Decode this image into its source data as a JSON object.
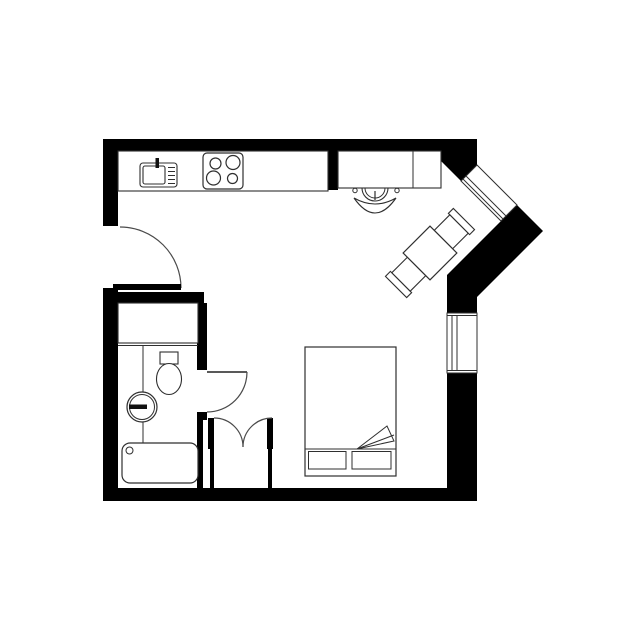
{
  "canvas": {
    "width": 640,
    "height": 640,
    "background": "#ffffff"
  },
  "palette": {
    "wall": "#000000",
    "furniture_line": "#2f2f2f",
    "door_line": "#4a4a4a",
    "fill_white": "#ffffff"
  },
  "plan": {
    "layers": [
      {
        "name": "walls",
        "shapes": [
          {
            "name": "top-and-diagonal-wall",
            "kind": "poly",
            "pts": "103,139 477,139 477,165 461,181 440,160 440,151 103,151",
            "f": "#000000"
          },
          {
            "name": "left-wall-upper",
            "kind": "rect",
            "x": 103,
            "y": 139,
            "w": 15,
            "h": 87,
            "f": "#000000"
          },
          {
            "name": "left-wall-lower",
            "kind": "rect",
            "x": 103,
            "y": 288,
            "w": 15,
            "h": 213,
            "f": "#000000"
          },
          {
            "name": "bottom-wall",
            "kind": "rect",
            "x": 103,
            "y": 488,
            "w": 374,
            "h": 13,
            "f": "#000000"
          },
          {
            "name": "right-wall-lower",
            "kind": "rect",
            "x": 447,
            "y": 373,
            "w": 30,
            "h": 128,
            "f": "#000000"
          },
          {
            "name": "right-wall-mid-chunk",
            "kind": "poly",
            "pts": "516,204 543,231 477,297 477,313 447,313 447,275 501,221",
            "f": "#000000"
          },
          {
            "name": "kitchen-desk-divider-stub",
            "kind": "rect",
            "x": 328,
            "y": 151,
            "w": 10,
            "h": 39,
            "f": "#000000"
          },
          {
            "name": "bathroom-top-wall",
            "kind": "rect",
            "x": 118,
            "y": 292,
            "w": 86,
            "h": 11,
            "f": "#000000"
          },
          {
            "name": "bathroom-side-wall",
            "kind": "rect",
            "x": 197,
            "y": 303,
            "w": 10,
            "h": 67,
            "f": "#000000"
          },
          {
            "name": "bathroom-door-stub",
            "kind": "rect",
            "x": 197,
            "y": 412,
            "w": 10,
            "h": 8,
            "f": "#000000"
          },
          {
            "name": "bathroom-lower-wall",
            "kind": "rect",
            "x": 197,
            "y": 420,
            "w": 6,
            "h": 68,
            "f": "#000000"
          }
        ]
      },
      {
        "name": "windows",
        "shapes": [
          {
            "name": "diagonal-window-frame",
            "kind": "poly",
            "pts": "477,165 517,205 501,221 461,181",
            "f": "#ffffff",
            "s": "#2f2f2f",
            "sw": 1
          },
          {
            "name": "diagonal-window-glass-line-1",
            "kind": "line",
            "x1": 463,
            "y1": 179,
            "x2": 503,
            "y2": 219,
            "s": "#2f2f2f",
            "sw": 1
          },
          {
            "name": "diagonal-window-glass-line-2",
            "kind": "line",
            "x1": 466,
            "y1": 176,
            "x2": 506,
            "y2": 216,
            "s": "#2f2f2f",
            "sw": 1
          },
          {
            "name": "right-window-frame",
            "kind": "rect",
            "x": 447,
            "y": 313,
            "w": 30,
            "h": 60,
            "f": "#ffffff",
            "s": "#2f2f2f",
            "sw": 1
          },
          {
            "name": "right-window-sill-top",
            "kind": "line",
            "x1": 447,
            "y1": 315.5,
            "x2": 477,
            "y2": 315.5,
            "s": "#2f2f2f",
            "sw": 1
          },
          {
            "name": "right-window-sill-bottom",
            "kind": "line",
            "x1": 447,
            "y1": 370.5,
            "x2": 477,
            "y2": 370.5,
            "s": "#2f2f2f",
            "sw": 1
          },
          {
            "name": "right-window-glass-line-1",
            "kind": "line",
            "x1": 452,
            "y1": 315,
            "x2": 452,
            "y2": 371,
            "s": "#2f2f2f",
            "sw": 1
          },
          {
            "name": "right-window-glass-line-2",
            "kind": "line",
            "x1": 457,
            "y1": 315,
            "x2": 457,
            "y2": 371,
            "s": "#2f2f2f",
            "sw": 1
          }
        ]
      },
      {
        "name": "doors",
        "shapes": [
          {
            "name": "entry-door-swing-arc",
            "kind": "path",
            "d": "M120,227 A61,61 0 0 1 181,288",
            "s": "#4a4a4a",
            "sw": 1.2
          },
          {
            "name": "entry-door-leaf",
            "kind": "rect",
            "x": 113,
            "y": 284,
            "w": 68,
            "h": 6,
            "f": "#000000"
          },
          {
            "name": "bathroom-door-leaf",
            "kind": "line",
            "x1": 207,
            "y1": 372,
            "x2": 247,
            "y2": 372,
            "s": "#222222",
            "sw": 1.6
          },
          {
            "name": "bathroom-door-swing-arc",
            "kind": "path",
            "d": "M247,372 A40,40 0 0 1 207,412",
            "s": "#4a4a4a",
            "sw": 1.2
          }
        ]
      },
      {
        "name": "closet",
        "shapes": [
          {
            "name": "closet-left-leaf",
            "kind": "rect",
            "x": 208,
            "y": 418,
            "w": 6,
            "h": 31,
            "f": "#000000"
          },
          {
            "name": "closet-left-jamb-lower",
            "kind": "rect",
            "x": 210,
            "y": 449,
            "w": 4,
            "h": 39,
            "f": "#000000"
          },
          {
            "name": "closet-right-leaf",
            "kind": "rect",
            "x": 267,
            "y": 418,
            "w": 6,
            "h": 31,
            "f": "#000000"
          },
          {
            "name": "closet-right-jamb-lower",
            "kind": "rect",
            "x": 268,
            "y": 449,
            "w": 4,
            "h": 39,
            "f": "#000000"
          },
          {
            "name": "closet-left-swing-arc",
            "kind": "path",
            "d": "M214,418 A29,29 0 0 1 243,447",
            "s": "#4a4a4a",
            "sw": 1.2
          },
          {
            "name": "closet-right-swing-arc",
            "kind": "path",
            "d": "M272,418 A29,29 0 0 0 243,447",
            "s": "#4a4a4a",
            "sw": 1.2
          }
        ]
      },
      {
        "name": "kitchen",
        "shapes": [
          {
            "name": "kitchen-counter",
            "kind": "rect",
            "x": 118,
            "y": 151,
            "w": 210,
            "h": 40,
            "f": "#ffffff",
            "s": "#2f2f2f",
            "sw": 1.1
          },
          {
            "name": "kitchen-sink-unit",
            "kind": "rect",
            "x": 140,
            "y": 163,
            "w": 37,
            "h": 24,
            "rx": 3,
            "f": "#ffffff",
            "s": "#2f2f2f",
            "sw": 1.1
          },
          {
            "name": "kitchen-sink-basin",
            "kind": "rect",
            "x": 143,
            "y": 166,
            "w": 22,
            "h": 18,
            "rx": 2,
            "f": "#ffffff",
            "s": "#2f2f2f",
            "sw": 1.1
          },
          {
            "name": "sink-drainer-line-1",
            "kind": "line",
            "x1": 168,
            "y1": 167.5,
            "x2": 175,
            "y2": 167.5,
            "s": "#2f2f2f",
            "sw": 1
          },
          {
            "name": "sink-drainer-line-2",
            "kind": "line",
            "x1": 168,
            "y1": 171.5,
            "x2": 175,
            "y2": 171.5,
            "s": "#2f2f2f",
            "sw": 1
          },
          {
            "name": "sink-drainer-line-3",
            "kind": "line",
            "x1": 168,
            "y1": 175.5,
            "x2": 175,
            "y2": 175.5,
            "s": "#2f2f2f",
            "sw": 1
          },
          {
            "name": "sink-drainer-line-4",
            "kind": "line",
            "x1": 168,
            "y1": 179.5,
            "x2": 175,
            "y2": 179.5,
            "s": "#2f2f2f",
            "sw": 1
          },
          {
            "name": "sink-drainer-line-5",
            "kind": "line",
            "x1": 168,
            "y1": 183.5,
            "x2": 175,
            "y2": 183.5,
            "s": "#2f2f2f",
            "sw": 1
          },
          {
            "name": "sink-faucet",
            "kind": "rect",
            "x": 155.5,
            "y": 158,
            "w": 3.5,
            "h": 10,
            "f": "#111111"
          },
          {
            "name": "stove",
            "kind": "rect",
            "x": 203,
            "y": 153,
            "w": 40,
            "h": 36,
            "rx": 4,
            "f": "#ffffff",
            "s": "#2f2f2f",
            "sw": 1.2
          },
          {
            "name": "stove-burner-top-left",
            "kind": "circle",
            "cx": 215.5,
            "cy": 163.5,
            "r": 5.5,
            "f": "#ffffff",
            "s": "#2f2f2f",
            "sw": 1.2
          },
          {
            "name": "stove-burner-top-right",
            "kind": "circle",
            "cx": 233,
            "cy": 162.5,
            "r": 7,
            "f": "#ffffff",
            "s": "#2f2f2f",
            "sw": 1.2
          },
          {
            "name": "stove-burner-bottom-left",
            "kind": "circle",
            "cx": 213.5,
            "cy": 178,
            "r": 7,
            "f": "#ffffff",
            "s": "#2f2f2f",
            "sw": 1.2
          },
          {
            "name": "stove-burner-bottom-right",
            "kind": "circle",
            "cx": 232.5,
            "cy": 178.5,
            "r": 5,
            "f": "#ffffff",
            "s": "#2f2f2f",
            "sw": 1.2
          }
        ]
      },
      {
        "name": "workspace",
        "shapes": [
          {
            "name": "office-chair-seat-outer",
            "kind": "circle",
            "cx": 375,
            "cy": 188,
            "r": 13,
            "f": "#ffffff",
            "s": "#2f2f2f",
            "sw": 1.1
          },
          {
            "name": "office-chair-seat-inner",
            "kind": "circle",
            "cx": 375,
            "cy": 188,
            "r": 10,
            "f": "none",
            "s": "#2f2f2f",
            "sw": 1
          },
          {
            "name": "office-chair-armrest-left",
            "kind": "circle",
            "cx": 355,
            "cy": 190.5,
            "r": 2.2,
            "f": "#ffffff",
            "s": "#2f2f2f",
            "sw": 1
          },
          {
            "name": "office-chair-armrest-right",
            "kind": "circle",
            "cx": 397,
            "cy": 190.5,
            "r": 2.2,
            "f": "#ffffff",
            "s": "#2f2f2f",
            "sw": 1
          },
          {
            "name": "office-chair-stem",
            "kind": "line",
            "x1": 375,
            "y1": 191,
            "x2": 375,
            "y2": 200,
            "s": "#2f2f2f",
            "sw": 1.2
          },
          {
            "name": "office-chair-backrest",
            "kind": "path",
            "d": "M354,198 Q375,210 396,198 Q375,228 354,198 Z",
            "f": "#ffffff",
            "s": "#2f2f2f",
            "sw": 1.1
          },
          {
            "name": "desk",
            "kind": "rect",
            "x": 338,
            "y": 151,
            "w": 103,
            "h": 37,
            "f": "#ffffff",
            "s": "#2f2f2f",
            "sw": 1.1
          },
          {
            "name": "desk-divider-line",
            "kind": "line",
            "x1": 413,
            "y1": 151,
            "x2": 413,
            "y2": 188,
            "s": "#2f2f2f",
            "sw": 1
          }
        ]
      },
      {
        "name": "dining",
        "transform": "rotate(-45 430 253)",
        "shapes": [
          {
            "name": "dining-chair-ne-back",
            "kind": "rect",
            "x": 471,
            "y": 238,
            "w": 7,
            "h": 30,
            "f": "#ffffff",
            "s": "#2f2f2f",
            "sw": 1.1
          },
          {
            "name": "dining-chair-ne-seat",
            "kind": "rect",
            "x": 449,
            "y": 240,
            "w": 22,
            "h": 26,
            "f": "#ffffff",
            "s": "#2f2f2f",
            "sw": 1.1
          },
          {
            "name": "dining-chair-sw-back",
            "kind": "rect",
            "x": 382,
            "y": 238,
            "w": 7,
            "h": 30,
            "f": "#ffffff",
            "s": "#2f2f2f",
            "sw": 1.1
          },
          {
            "name": "dining-chair-sw-seat",
            "kind": "rect",
            "x": 389,
            "y": 240,
            "w": 22,
            "h": 26,
            "f": "#ffffff",
            "s": "#2f2f2f",
            "sw": 1.1
          },
          {
            "name": "dining-table",
            "kind": "rect",
            "x": 411,
            "y": 234,
            "w": 38,
            "h": 38,
            "f": "#ffffff",
            "s": "#2f2f2f",
            "sw": 1.2
          }
        ]
      },
      {
        "name": "bathroom",
        "shapes": [
          {
            "name": "vanity-counter",
            "kind": "rect",
            "x": 118,
            "y": 303,
            "w": 80,
            "h": 40,
            "f": "#ffffff",
            "s": "#2f2f2f",
            "sw": 1.1
          },
          {
            "name": "vanity-front-edge",
            "kind": "line",
            "x1": 118,
            "y1": 345.5,
            "x2": 198,
            "y2": 345.5,
            "s": "#2f2f2f",
            "sw": 1
          },
          {
            "name": "plumbing-line",
            "kind": "line",
            "x1": 143,
            "y1": 345,
            "x2": 143,
            "y2": 443,
            "s": "#2f2f2f",
            "sw": 1
          },
          {
            "name": "toilet-tank",
            "kind": "rect",
            "x": 160,
            "y": 352,
            "w": 18,
            "h": 12,
            "f": "#ffffff",
            "s": "#2f2f2f",
            "sw": 1.1
          },
          {
            "name": "toilet-bowl",
            "kind": "ellipse",
            "cx": 169,
            "cy": 379,
            "rx": 12.5,
            "ry": 15.5,
            "f": "#ffffff",
            "s": "#2f2f2f",
            "sw": 1.1
          },
          {
            "name": "washbasin-outer",
            "kind": "circle",
            "cx": 142,
            "cy": 407,
            "r": 15,
            "f": "#ffffff",
            "s": "#2f2f2f",
            "sw": 1.2
          },
          {
            "name": "washbasin-inner",
            "kind": "circle",
            "cx": 142,
            "cy": 407,
            "r": 12.5,
            "f": "none",
            "s": "#2f2f2f",
            "sw": 1
          },
          {
            "name": "washbasin-faucet",
            "kind": "rect",
            "x": 129,
            "y": 404.5,
            "w": 18,
            "h": 4.5,
            "f": "#111111"
          },
          {
            "name": "bathtub",
            "kind": "rect",
            "x": 122,
            "y": 443,
            "w": 76,
            "h": 40,
            "rx": 8,
            "f": "#ffffff",
            "s": "#2f2f2f",
            "sw": 1.2
          },
          {
            "name": "bathtub-drain",
            "kind": "circle",
            "cx": 129.5,
            "cy": 450.5,
            "r": 3.5,
            "f": "#ffffff",
            "s": "#2f2f2f",
            "sw": 1
          }
        ]
      },
      {
        "name": "bedroom",
        "shapes": [
          {
            "name": "bed-frame",
            "kind": "rect",
            "x": 305,
            "y": 347,
            "w": 91,
            "h": 129,
            "f": "#ffffff",
            "s": "#2f2f2f",
            "sw": 1.2
          },
          {
            "name": "bed-mattress-line",
            "kind": "line",
            "x1": 305,
            "y1": 449,
            "x2": 396,
            "y2": 449,
            "s": "#2f2f2f",
            "sw": 1
          },
          {
            "name": "pillow-left",
            "kind": "rect",
            "x": 308.5,
            "y": 451.5,
            "w": 37.5,
            "h": 17.5,
            "f": "#ffffff",
            "s": "#2f2f2f",
            "sw": 1
          },
          {
            "name": "pillow-right",
            "kind": "rect",
            "x": 352,
            "y": 451.5,
            "w": 39,
            "h": 17.5,
            "f": "#ffffff",
            "s": "#2f2f2f",
            "sw": 1
          },
          {
            "name": "blanket-fold",
            "kind": "poly",
            "pts": "357,449 387,426 394,441",
            "f": "#ffffff",
            "s": "#2f2f2f",
            "sw": 1
          },
          {
            "name": "blanket-fold-crease",
            "kind": "line",
            "x1": 357,
            "y1": 449,
            "x2": 394,
            "y2": 435,
            "s": "#2f2f2f",
            "sw": 1
          }
        ]
      }
    ]
  }
}
